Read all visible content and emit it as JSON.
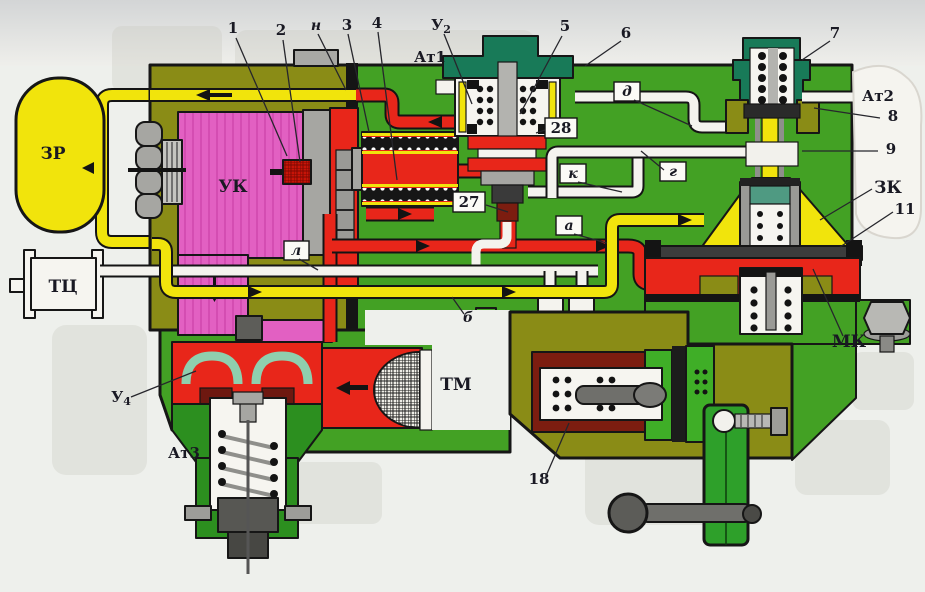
{
  "diagram": {
    "components": {
      "zr": "ЗР",
      "tc": "ТЦ",
      "uk": "УК",
      "tm": "ТМ",
      "mk": "МК",
      "zk": "ЗК",
      "at1": "Ат1",
      "at2": "Ат2",
      "at3": "Ат3",
      "u2": {
        "base": "У",
        "sub": "2"
      },
      "u4": {
        "base": "У",
        "sub": "4"
      }
    },
    "callouts": {
      "c1": "1",
      "c2": "2",
      "c3": "3",
      "c4": "4",
      "c5": "5",
      "c6": "6",
      "c7": "7",
      "c8": "8",
      "c9": "9",
      "c11": "11",
      "c18": "18",
      "c27": "27",
      "c28": "28"
    },
    "channels": {
      "n": "н",
      "l": "л",
      "b": "б",
      "a": "а",
      "k": "к",
      "g": "г",
      "d": "д"
    },
    "colors": {
      "body_green": "#43a124",
      "body_olive": "#8a8c16",
      "chamber_pink": "#e260c2",
      "pressure_red": "#e8261a",
      "air_yellow": "#f1e40c",
      "cap_teal": "#187a58",
      "maroon": "#7c1d10"
    }
  }
}
